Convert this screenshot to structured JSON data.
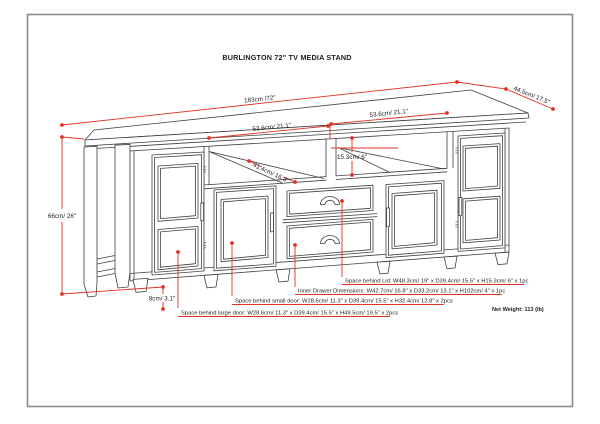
{
  "page": {
    "title": "BURLINGTON 72\" TV MEDIA STAND",
    "net_weight": "Net Weight: 113 (lb)"
  },
  "dimensions": {
    "top_width": "183cm /72\"",
    "top_depth": "44.5cm/ 17.5\"",
    "left_opening_width": "53.6cm/ 21.1\"",
    "right_opening_width": "53.6cm/ 21.1\"",
    "opening_height": "15.3cm/ 6\"",
    "opening_depth": "41.4cm/ 16.3\"",
    "overall_height": "66cm/ 26\"",
    "leg_height": "8cm/ 3.1\""
  },
  "notes": {
    "lid": "Space behind Lid: W48.3cm/ 19\" x D39.4cm/ 15.5\" x H15.3cm/ 6\" x 1pc",
    "inner_drawer": "Inner Drawer Dimensions: W42.7cm/ 16.8\" x D33.2cm/ 13.1\" x H102cm/ 4\" x 1pc",
    "small_door": "Space behind small door: W28.6cm/ 11.3\" x D39.4cm/ 15.5\" x H32.4cm/ 12.8\" x 2pcs",
    "large_door": "Space behind large door: W28.6cm/ 11.3\" x D39.4cm/ 15.5\" x H49.5cm/ 19.5\" x 2pcs"
  },
  "colors": {
    "dimension_red": "#e23227",
    "line_art": "#404040",
    "border_gray": "#8a8a8a"
  }
}
